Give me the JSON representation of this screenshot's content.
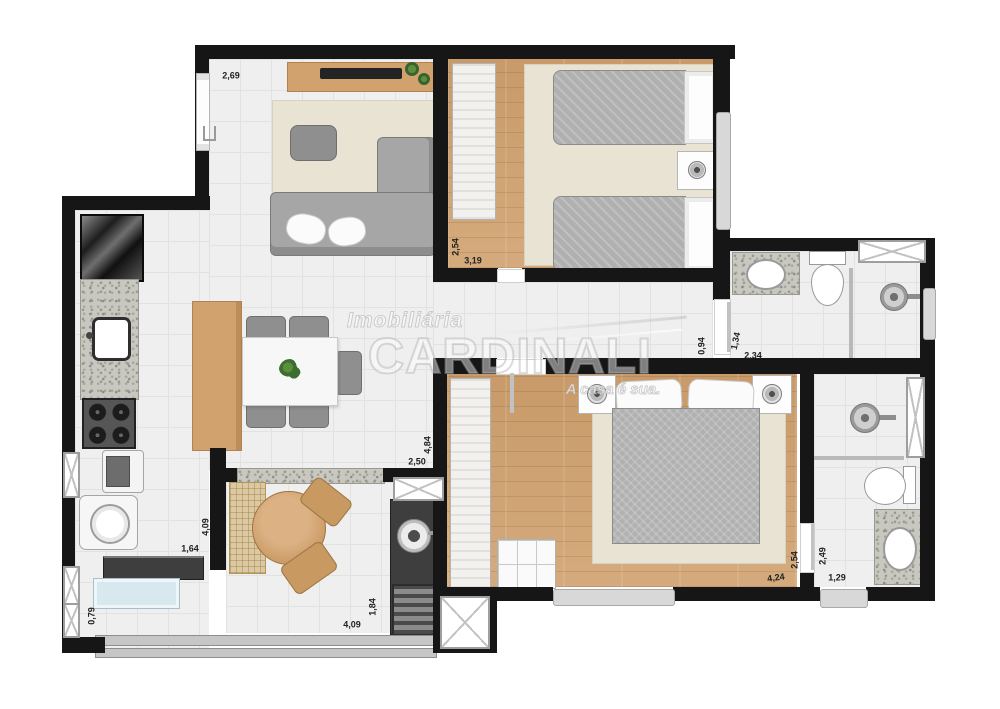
{
  "watermark": {
    "brand_top": "Imobiliária",
    "brand_main": "CARDINALI",
    "tagline": "A casa é sua."
  },
  "dimension_labels": [
    {
      "text": "2,69",
      "x": 231,
      "y": 76,
      "rot": 0
    },
    {
      "text": "2,54",
      "x": 456,
      "y": 247,
      "rot": -90
    },
    {
      "text": "3,19",
      "x": 473,
      "y": 261,
      "rot": 0
    },
    {
      "text": "0,94",
      "x": 702,
      "y": 346,
      "rot": -90
    },
    {
      "text": "1,34",
      "x": 736,
      "y": 341,
      "rot": -78
    },
    {
      "text": "2,34",
      "x": 753,
      "y": 356,
      "rot": 0
    },
    {
      "text": "4,84",
      "x": 428,
      "y": 445,
      "rot": -90
    },
    {
      "text": "2,50",
      "x": 417,
      "y": 462,
      "rot": 0
    },
    {
      "text": "4,09",
      "x": 206,
      "y": 527,
      "rot": -90
    },
    {
      "text": "1,64",
      "x": 190,
      "y": 549,
      "rot": 0
    },
    {
      "text": "0,79",
      "x": 92,
      "y": 616,
      "rot": -90
    },
    {
      "text": "1,84",
      "x": 373,
      "y": 607,
      "rot": -90
    },
    {
      "text": "4,09",
      "x": 352,
      "y": 625,
      "rot": 0
    },
    {
      "text": "4,24",
      "x": 776,
      "y": 578,
      "rot": -8
    },
    {
      "text": "2,54",
      "x": 795,
      "y": 560,
      "rot": -90
    },
    {
      "text": "2,49",
      "x": 823,
      "y": 556,
      "rot": -90
    },
    {
      "text": "1,29",
      "x": 837,
      "y": 578,
      "rot": 0
    }
  ],
  "colors": {
    "wall": "#161616",
    "tile_floor": "#efefef",
    "wood_floor": "#cfa273",
    "wood_furniture": "#d2a26e",
    "rug": "#e9e3d4",
    "sofa_gray": "#a6a6a6",
    "dark_counter": "#3e3e3e",
    "glass_blue": "#d7e8ef",
    "granite": "#c9c8c0"
  }
}
